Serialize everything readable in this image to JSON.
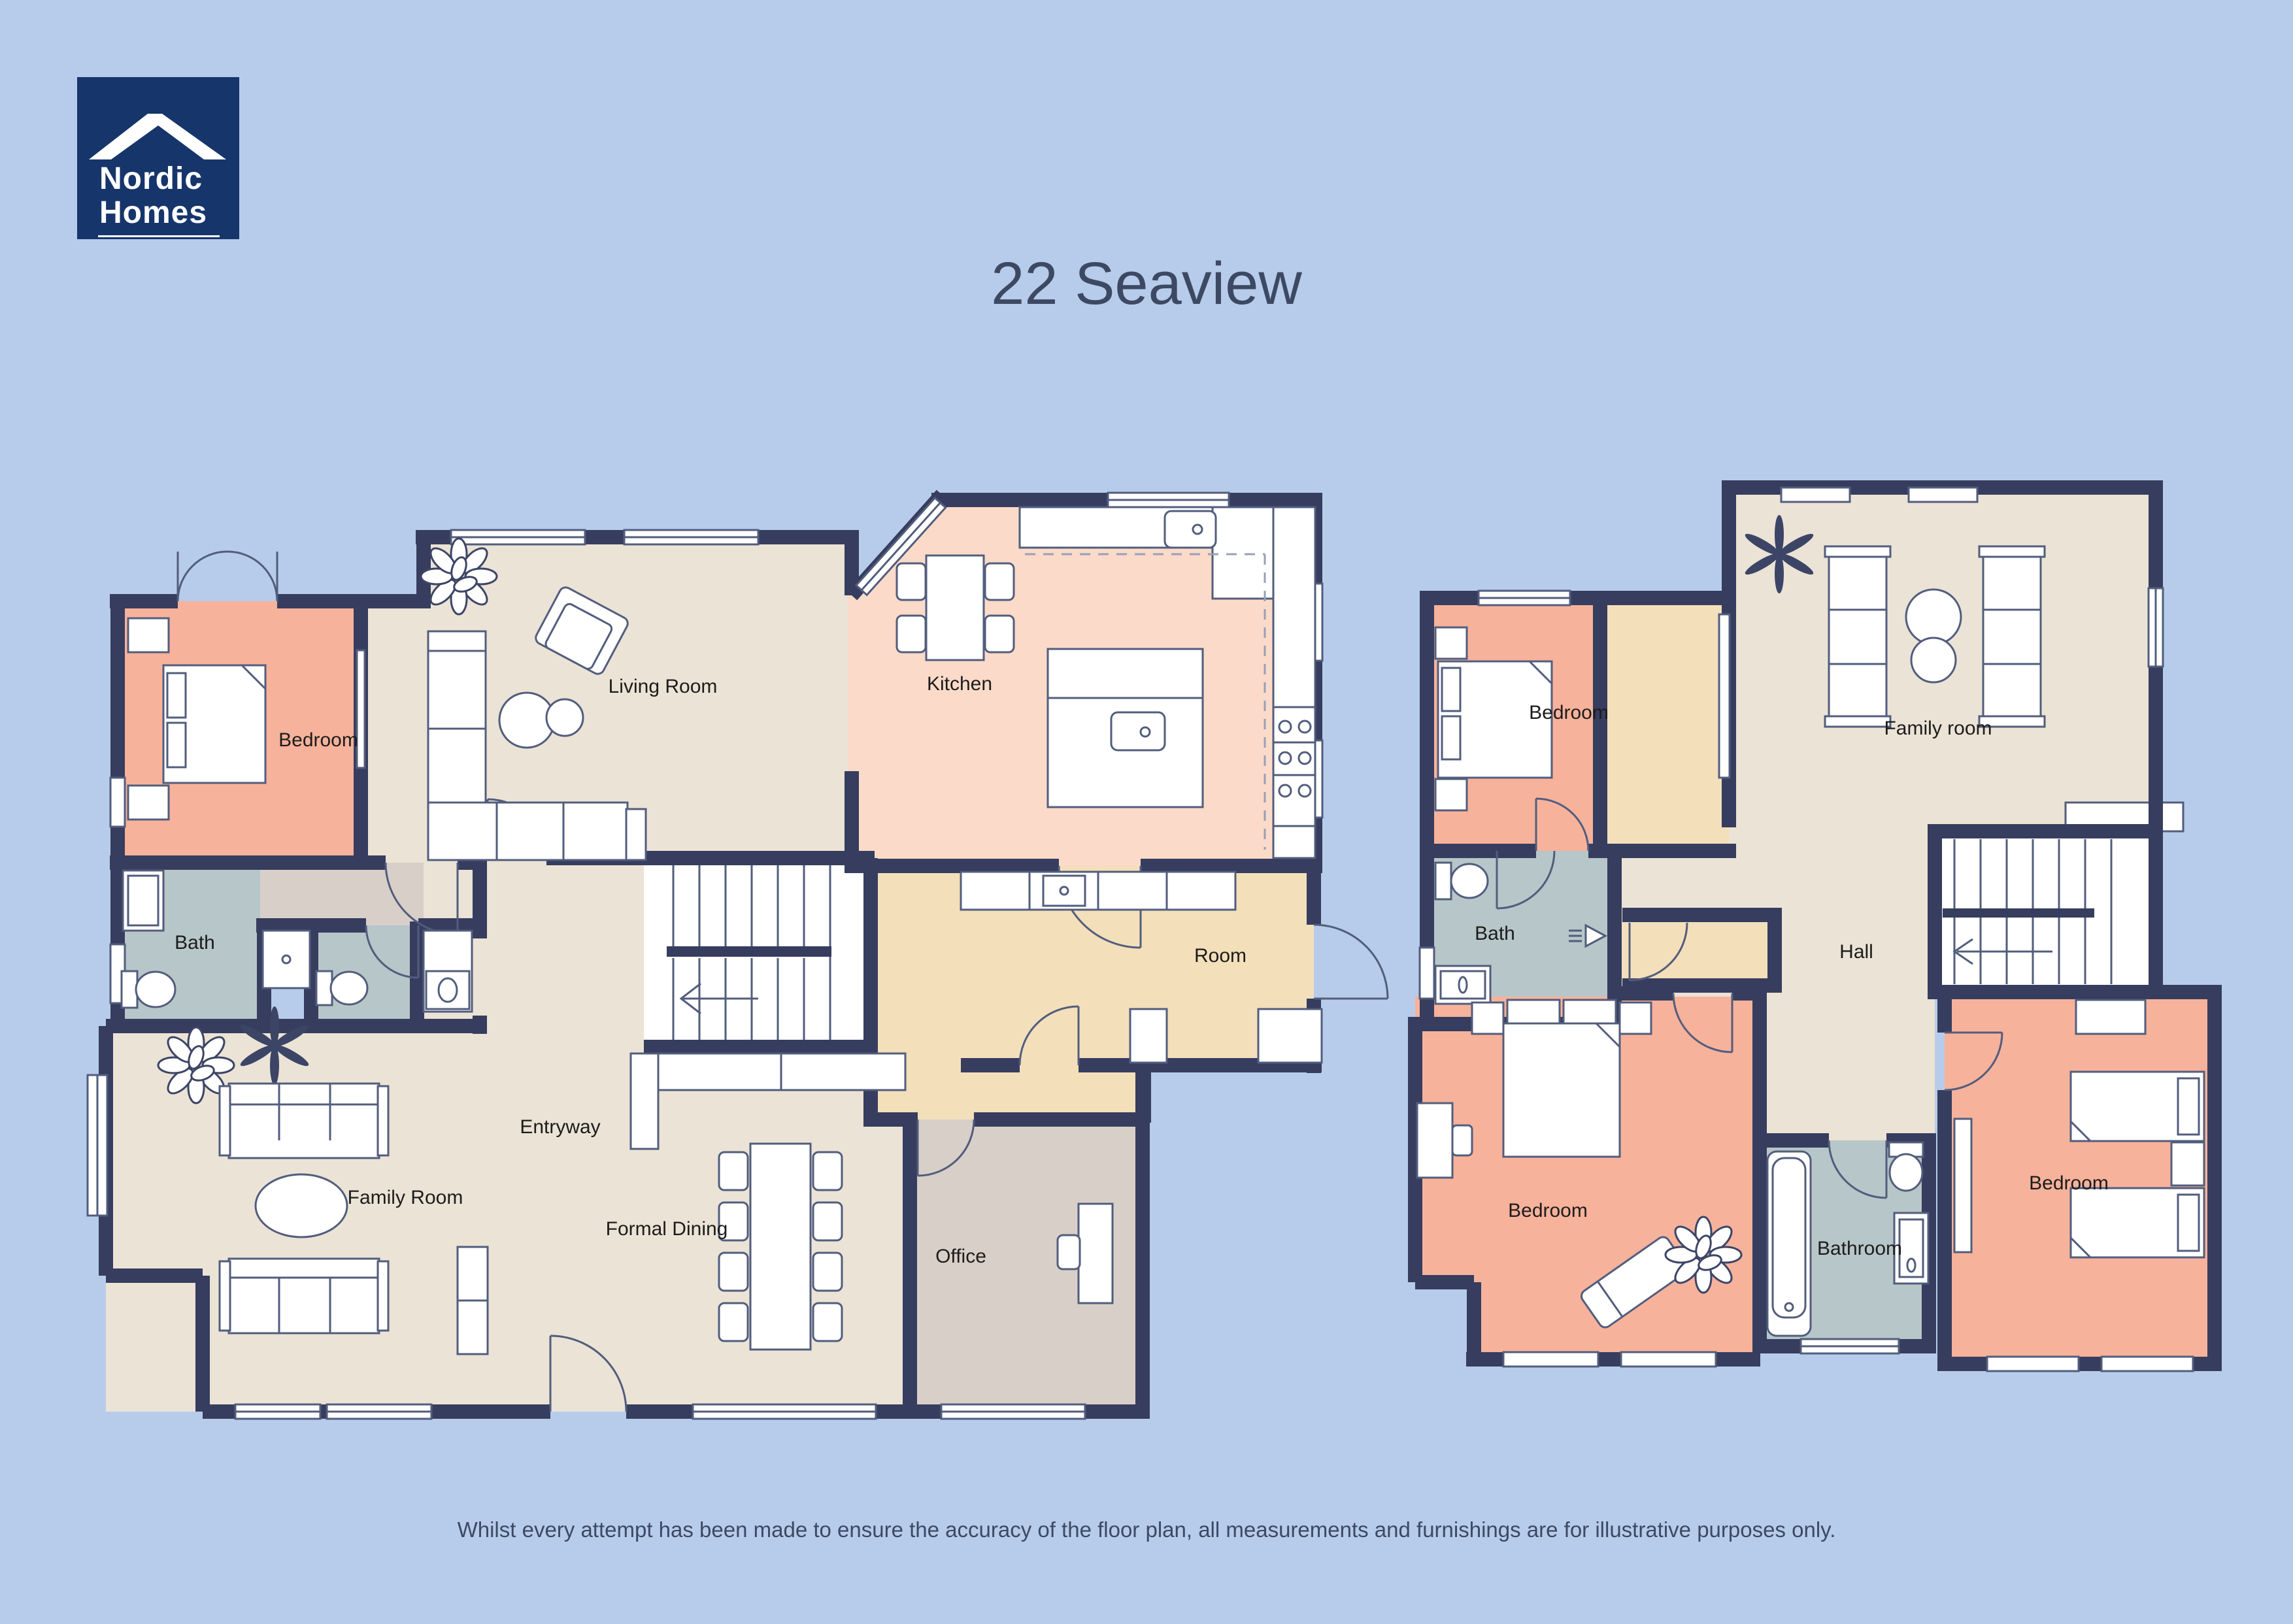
{
  "title": "22 Seaview",
  "disclaimer": "Whilst every attempt has been made to ensure the accuracy of the floor plan, all measurements and furnishings are for illustrative purposes only.",
  "logo": {
    "line1": "Nordic",
    "line2": "Homes",
    "icon": "roof-icon"
  },
  "palette": {
    "bg": "#b7cceb",
    "wall": "#363d5e",
    "floor": "#ebe3d5",
    "salmon": "#f7b29b",
    "kitchen": "#fbdac9",
    "tan": "#f4dfbb",
    "taupe": "#d8cfc8",
    "bath": "#b7c6c8",
    "furn": "#525d7d",
    "label": "#1c1c1c",
    "text": "#3d4963",
    "logoBg": "#16356b"
  },
  "icons": {
    "roof": "roof-icon",
    "plant": "plant-icon",
    "fern": "fern-icon",
    "stair_arrow": "stair-direction-arrow",
    "shower_head": "shower-head-icon"
  },
  "plans": {
    "ground": {
      "rooms": [
        {
          "label": "Bedroom"
        },
        {
          "label": "Living Room"
        },
        {
          "label": "Kitchen"
        },
        {
          "label": "Bath"
        },
        {
          "label": "Family Room"
        },
        {
          "label": "Entryway"
        },
        {
          "label": "Formal Dining"
        },
        {
          "label": "Office"
        },
        {
          "label": "Room"
        }
      ]
    },
    "first": {
      "rooms": [
        {
          "label": "Bedroom"
        },
        {
          "label": "Family room"
        },
        {
          "label": "Bath"
        },
        {
          "label": "Hall"
        },
        {
          "label": "Bedroom"
        },
        {
          "label": "Bathroom"
        },
        {
          "label": "Bedroom"
        }
      ]
    }
  }
}
